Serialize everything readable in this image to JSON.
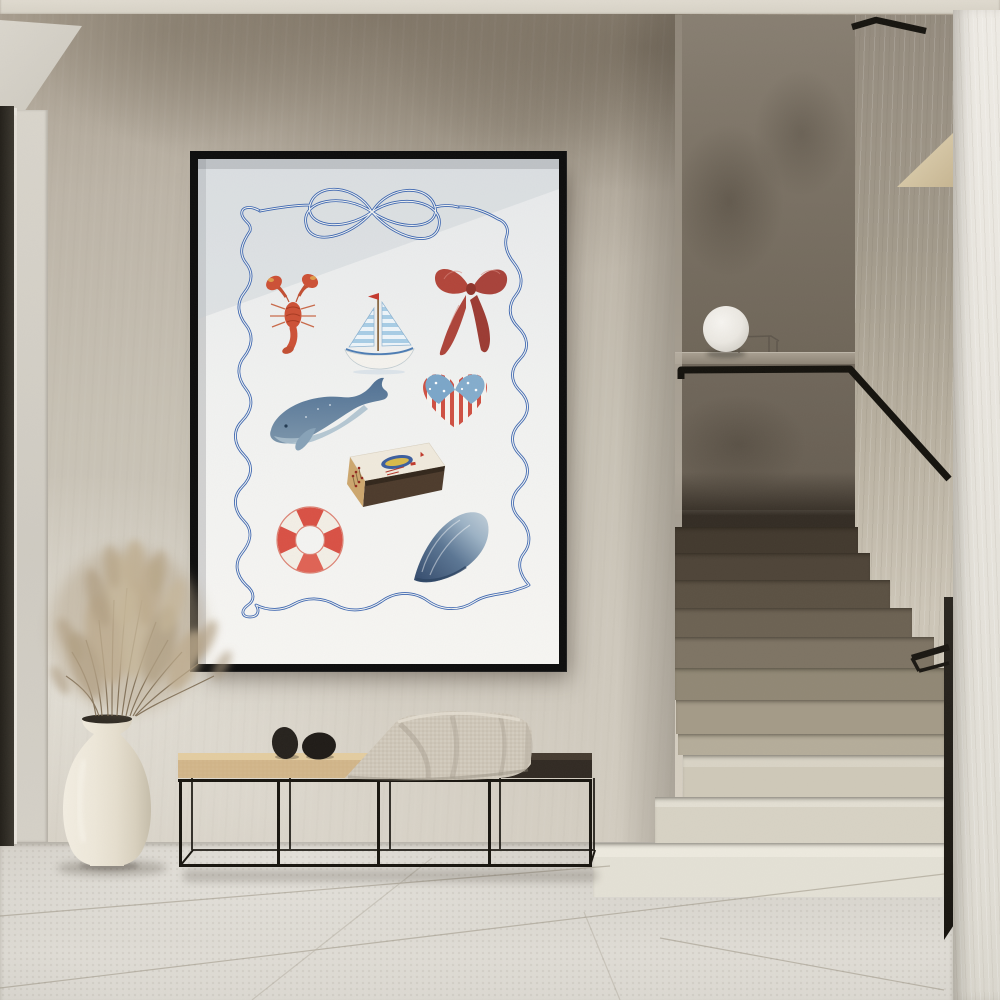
{
  "scene": {
    "label": "Minimal hallway interior with framed nautical art print, bench and terrazzo staircase",
    "wall": "textured beige plaster",
    "floor": "light stone tile",
    "accents": {
      "art_blue": "#3a64b0",
      "art_red": "#b2453a",
      "frame_black": "#0d0d0d",
      "seat_wood": "#d6ba8c",
      "rail_black": "#14120d",
      "vase_cream": "#eee8da"
    }
  },
  "poster": {
    "label": "Framed nautical watercolor art print",
    "frame": "thin black gallery frame",
    "paper": "white",
    "border": "wavy hand-drawn double blue ribbon border tied in a bow",
    "motifs": [
      "blue line-art ribbon bow",
      "red lobster",
      "sailboat with blue striped sails and red pennant",
      "dark red ribbon bow",
      "blue humpback whale",
      "heart patterned as american flag",
      "matchbox with sardine-tin label and red-tipped matches",
      "red and white life buoy",
      "blue mussel shell"
    ]
  },
  "furniture": {
    "bench": {
      "label": "low bench with thin black metal frame",
      "seat": "two-tone wood seat, light oak left and dark stained right",
      "objects": [
        "black pebble sculpture",
        "black pebble sculpture",
        "beige waffle-knit throw blanket"
      ]
    },
    "vase": {
      "label": "cream ceramic vase",
      "contents": "dried pampas grass"
    }
  },
  "staircase": {
    "label": "terrazzo staircase with black metal handrail",
    "lamp": "white globe lamp on landing ledge",
    "steps_visible": 11,
    "lighting": "upper steps in shadow, lower steps brightly lit"
  },
  "left_edge": {
    "label": "dark doorway reveal"
  }
}
